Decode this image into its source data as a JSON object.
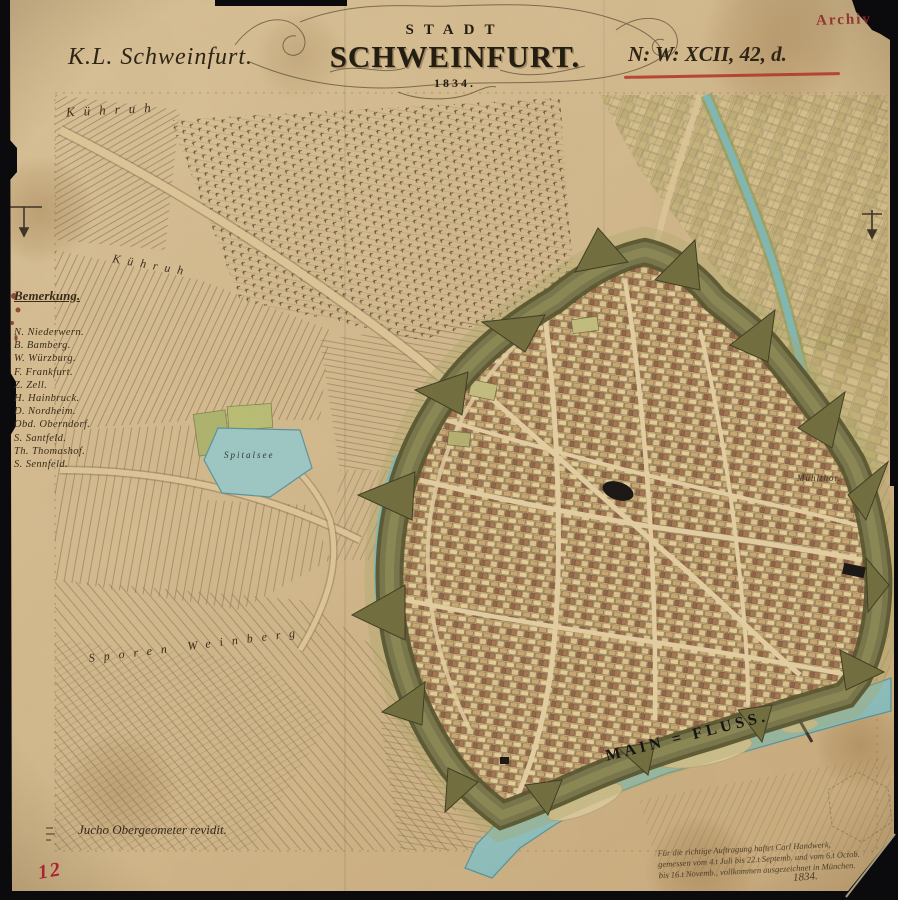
{
  "header": {
    "stamp": "Archiv",
    "series_label": "K.L. Schweinfurt.",
    "title_upper": "STADT",
    "title_main": "SCHWEINFURT.",
    "title_year": "1834.",
    "sheet_reference": "N: W: XCII, 42, d."
  },
  "legend": {
    "title": "Bemerkung.",
    "items": [
      "N. Niederwern.",
      "B. Bamberg.",
      "W. Würzburg.",
      "F. Frankfurt.",
      "Z. Zell.",
      "H. Hainbruck.",
      "D. Nordheim.",
      "Obd. Oberndorf.",
      "S. Santfeld.",
      "Th. Thomashof.",
      "S. Sennfeld."
    ]
  },
  "map_labels": {
    "field_top": "Kühruh",
    "field_mid": "Kühruh",
    "vineyard": "Sporen Weinberg",
    "lake": "Spitalsee",
    "mill_gate": "Mühlthor.",
    "river": "MAIN = FLUSS."
  },
  "footer": {
    "revision_note": "Jucho Obergeometer revidit.",
    "certification_lines": [
      "Für die richtige Auftragung haftet Carl Handwerk,",
      "gemessen vom 4.t Juli bis 22.t Septemb. und vom 6.t Octob.",
      "bis 16.t Novemb., vollkommen ausgezeichnet in München."
    ],
    "certification_year": "1834.",
    "sheet_number": "12"
  },
  "colors": {
    "paper": "#d4ba8e",
    "ink": "#32291b",
    "accent_red": "#b23327",
    "water": "#8ec2c0",
    "fortification": "#6f6c3d",
    "photo_background": "#0b0b0e"
  }
}
